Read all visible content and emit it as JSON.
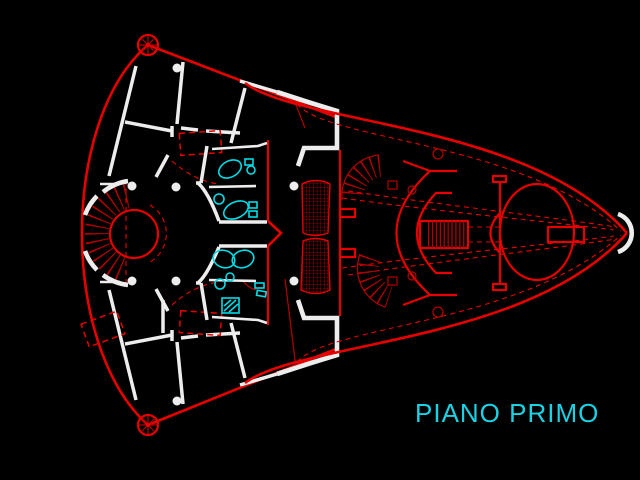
{
  "title": {
    "text": "PIANO PRIMO"
  },
  "colors": {
    "background": "#000000",
    "line_red": "#e60000",
    "line_red_dim": "#b40000",
    "wall_white": "#ededed",
    "fixture_cyan": "#00dce6",
    "title_cyan": "#1bd1e4"
  },
  "components": [
    "west-fan-wing",
    "central-circular-hall",
    "spiral-staircase",
    "bathroom-block",
    "gallery-slabs",
    "east-boat-wing",
    "floor-title"
  ]
}
